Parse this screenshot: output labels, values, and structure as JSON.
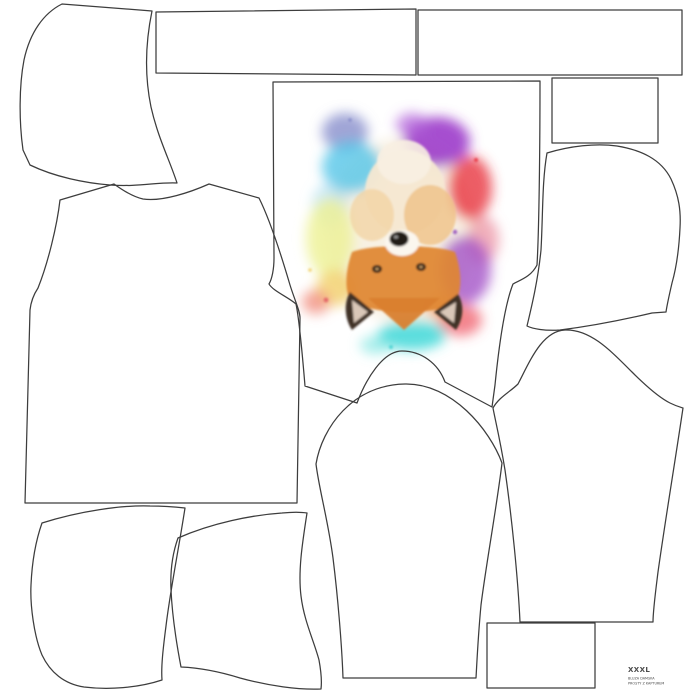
{
  "page": {
    "description": "Sewing pattern cut layout panel (hoodie) printed with watercolor fox artwork placed upside down on the front bodice piece",
    "background_color": "#ffffff",
    "outline_color": "#3d3d3d"
  },
  "size_label": {
    "size": "XXXL",
    "line2": "BLUZA DAMSKA",
    "line3": "PROSTY Z KAPTUREM"
  },
  "pieces": [
    {
      "name": "hood-side-left"
    },
    {
      "name": "waistband-strip-1"
    },
    {
      "name": "waistband-strip-2"
    },
    {
      "name": "small-rectangle-top-right"
    },
    {
      "name": "front-bodice-with-fox-print"
    },
    {
      "name": "back-bodice-left"
    },
    {
      "name": "hood-side-right"
    },
    {
      "name": "sleeve-center"
    },
    {
      "name": "sleeve-right"
    },
    {
      "name": "pocket-piece-left"
    },
    {
      "name": "pocket-piece-middle"
    },
    {
      "name": "small-rectangle-bottom-right"
    }
  ],
  "artwork": {
    "name": "watercolor-fox-upside-down",
    "palette": {
      "purple": "#9a35c8",
      "violet_blue": "#8087c8",
      "cyan": "#4fc4e8",
      "teal": "#3fd8d8",
      "red": "#e83240",
      "crimson": "#ef5360",
      "salmon": "#f08878",
      "yellow": "#eef29a",
      "gold": "#f2cf6a",
      "fox_orange": "#e0862f",
      "cream": "#f5e8d2",
      "dark_brown": "#3a2a1e"
    }
  }
}
